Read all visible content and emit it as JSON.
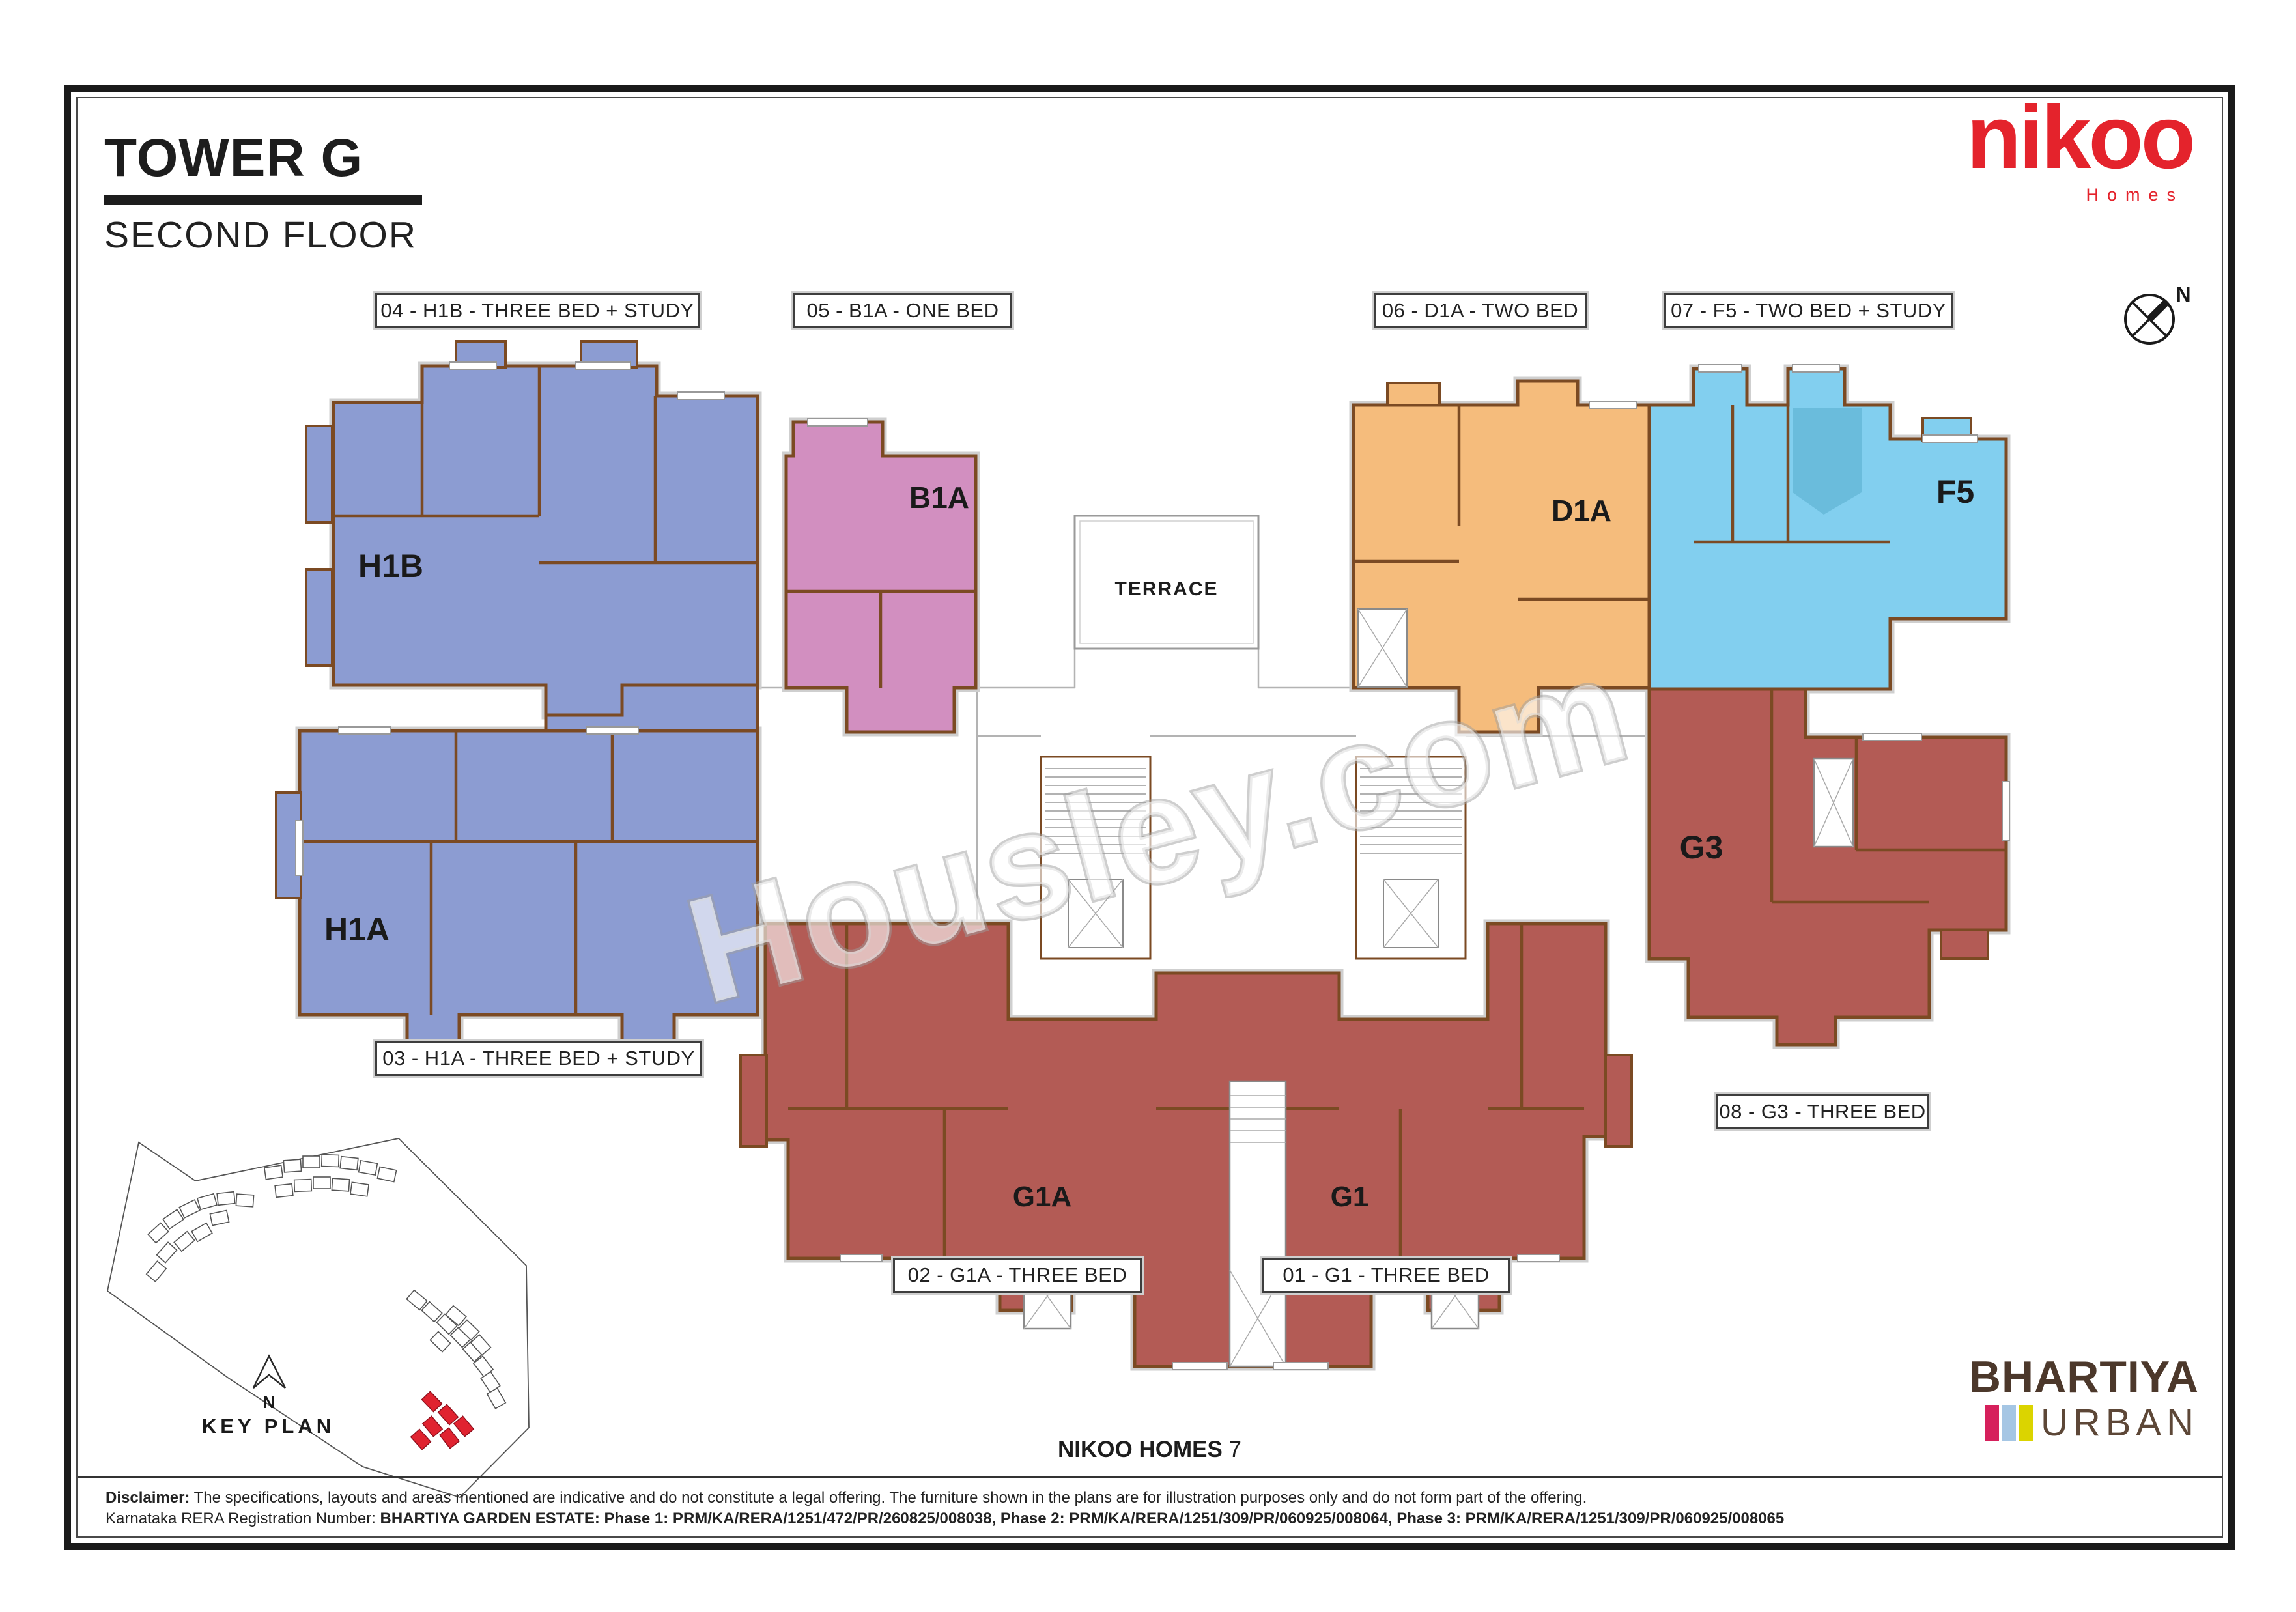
{
  "header": {
    "tower": "TOWER G",
    "floor": "SECOND FLOOR"
  },
  "brand": {
    "name": "nikoo",
    "sub": "Homes",
    "color": "#E4232C"
  },
  "compass": {
    "north": "N"
  },
  "unit_tags": [
    {
      "label": "04 - H1B - THREE BED + STUDY"
    },
    {
      "label": "05 - B1A - ONE BED"
    },
    {
      "label": "06 - D1A - TWO BED"
    },
    {
      "label": "07 - F5 - TWO BED + STUDY"
    },
    {
      "label": "03 - H1A - THREE BED + STUDY"
    },
    {
      "label": "08 - G3 - THREE BED"
    },
    {
      "label": "02 - G1A - THREE BED"
    },
    {
      "label": "01 - G1 - THREE BED"
    }
  ],
  "plan": {
    "labels": {
      "h1b": "H1B",
      "b1a": "B1A",
      "d1a": "D1A",
      "f5": "F5",
      "h1a": "H1A",
      "g3": "G3",
      "g1a": "G1A",
      "g1": "G1"
    },
    "terrace": "TERRACE"
  },
  "palette": {
    "blue": "#8C9CD2",
    "pink": "#D28FC0",
    "orange": "#F5BC7C",
    "cyan": "#82CFEF",
    "cyan_dark": "#66B9D8",
    "red_unit": "#B35B55",
    "wall": "#7B4A23",
    "keyplan_red": "#E02330"
  },
  "watermark": "Housley.com",
  "key_plan": {
    "title": "KEY PLAN",
    "north": "N"
  },
  "footer": {
    "project_bold": "NIKOO HOMES",
    "project_number": "7",
    "disclaimer_label": "Disclaimer:",
    "disclaimer_text": " The specifications, layouts and areas mentioned are indicative and do not constitute a legal offering. The furniture shown in the plans are for illustration purposes only and do not form part of the offering.",
    "rera_label": "Karnataka RERA Registration Number: ",
    "rera_bold": "BHARTIYA GARDEN ESTATE: Phase 1: PRM/KA/RERA/1251/472/PR/260825/008038, Phase 2: PRM/KA/RERA/1251/309/PR/060925/008064, Phase 3: PRM/KA/RERA/1251/309/PR/060925/008065"
  },
  "developer": {
    "name": "BHARTIYA",
    "sub": "URBAN",
    "bar_colors": [
      "#D6205C",
      "#A5C6E4",
      "#DBD400"
    ]
  }
}
